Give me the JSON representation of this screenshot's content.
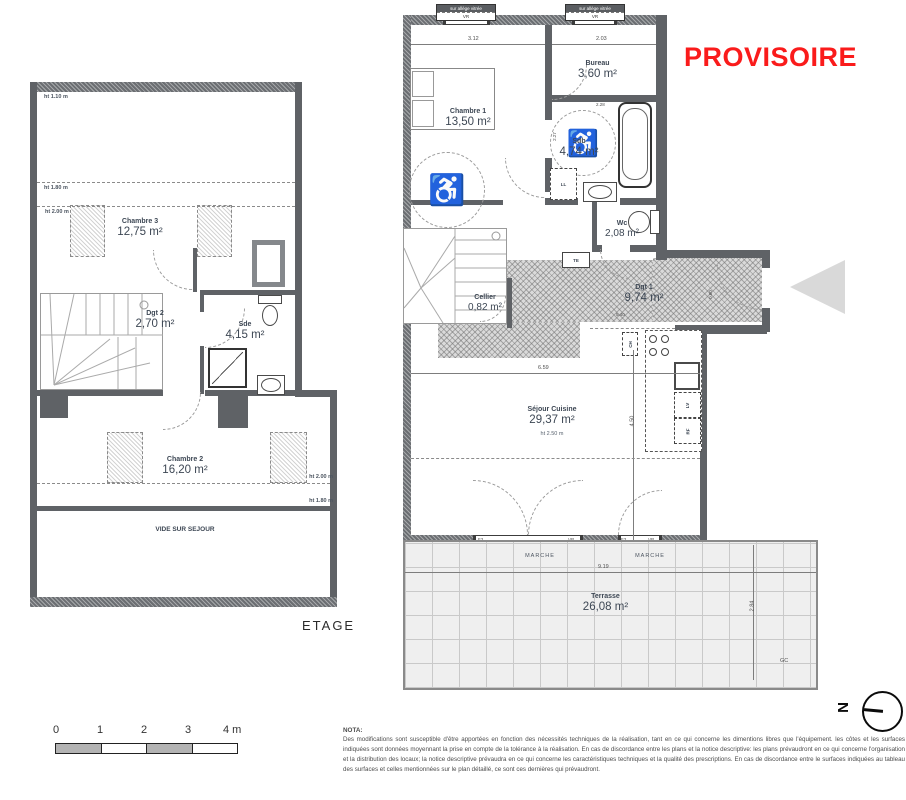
{
  "stamp": {
    "text": "PROVISOIRE"
  },
  "plans": {
    "etage": {
      "caption": "ETAGE",
      "rooms": {
        "chambre3": {
          "name": "Chambre 3",
          "area": "12,75 m²"
        },
        "dgt2": {
          "name": "Dgt 2",
          "area": "2,70 m²"
        },
        "sde": {
          "name": "Sde",
          "area": "4,15 m²"
        },
        "chambre2": {
          "name": "Chambre 2",
          "area": "16,20 m²"
        },
        "vide": {
          "name": "VIDE SUR SEJOUR"
        }
      },
      "height_marks": {
        "top": "ht 1.10 m",
        "mid": "ht 1.80 m",
        "low": "ht 2.00 m",
        "right_upper": "ht 2.00 m",
        "right_lower": "ht 1.80 m"
      }
    },
    "rdc": {
      "rooms": {
        "chambre1": {
          "name": "Chambre 1",
          "area": "13,50 m²"
        },
        "bureau": {
          "name": "Bureau",
          "area": "3,60 m²"
        },
        "sdb": {
          "name": "Sdb",
          "area": "4,74 m²"
        },
        "wc": {
          "name": "Wc",
          "area": "2,08 m²"
        },
        "cellier": {
          "name": "Cellier",
          "area": "0,82 m²"
        },
        "dgt1": {
          "name": "Dgt 1",
          "area": "9,74 m²"
        },
        "sejour": {
          "name": "Séjour Cuisine",
          "area": "29,37 m²",
          "height": "ht 2.50 m"
        },
        "terrasse": {
          "name": "Terrasse",
          "area": "26,08 m²"
        }
      },
      "windows": {
        "head": "sur allège vitrée",
        "tag": "VR",
        "f3": "F3"
      },
      "marche": "MARCHE",
      "dims": {
        "top_left": "3.12",
        "top_right": "2.03",
        "sdb_top": "2.28",
        "sdb_left": "2.27",
        "sejour_width": "6.59",
        "sejour_height": "4.50",
        "dgt1_width": "5.40",
        "entry_width": "0.60",
        "terrasse_width": "9.19",
        "terrasse_depth": "2.84"
      },
      "tags": {
        "ll": "LL",
        "te": "TE",
        "ch": "CH",
        "lv": "LV",
        "rf": "RF",
        "gc": "GC"
      }
    }
  },
  "scalebar": {
    "labels": [
      "0",
      "1",
      "2",
      "3",
      "4 m"
    ]
  },
  "north": {
    "letter": "N"
  },
  "nota": {
    "title": "NOTA:",
    "body": "Des modifications sont susceptible d'être apportées en fonction des nécessités techniques de la réalisation, tant en ce qui concerne les dimentions libres que l'équipement. les côtes et les surfaces indiquées sont données moyennant la prise en compte de la tolérance à la réalisation. En cas de discordance entre les plans et la notice descriptive: les plans prévaudront en ce qui concerne l'organisation et la distribution des locaux; la notice descriptive prévaudra en ce qui concerne les caractéristiques techniques et la qualité des prescriptions. En cas de discordance entre le surfaces indiquées au tableau des surfaces et celles mentionnées sur le plan détaillé, ce sont ces dernières qui prévaudront."
  }
}
